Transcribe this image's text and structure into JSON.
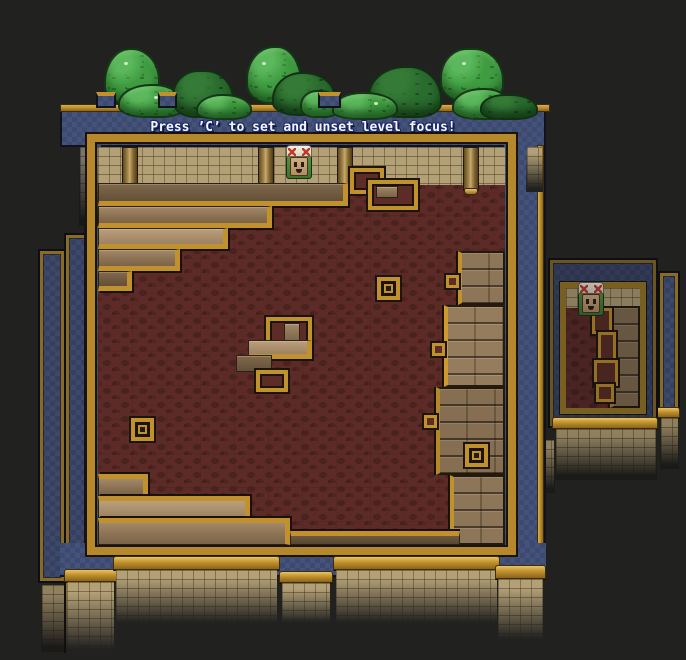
{
  "hud": {
    "focus_hint": "Press ’C’ to set and unset level focus!"
  },
  "scene": {
    "rooms": [
      {
        "id": "main-room",
        "focused": true
      },
      {
        "id": "side-room-left-outer",
        "focused": false
      },
      {
        "id": "side-room-left-inner",
        "focused": false
      },
      {
        "id": "side-room-right",
        "focused": false
      },
      {
        "id": "side-room-right-far",
        "focused": false
      }
    ],
    "characters": [
      {
        "id": "main-room-character",
        "location": "main-room"
      },
      {
        "id": "side-room-character",
        "location": "side-room-right"
      }
    ]
  },
  "theme": {
    "bg": "#21211f",
    "blue": "#3d4a70",
    "blue-dim": "#35405f",
    "gold": "#c0912c",
    "gold-light": "#e7c367",
    "gold-dark": "#7a5c16",
    "brick": "#b3a077",
    "floor": "#5c2b27"
  }
}
